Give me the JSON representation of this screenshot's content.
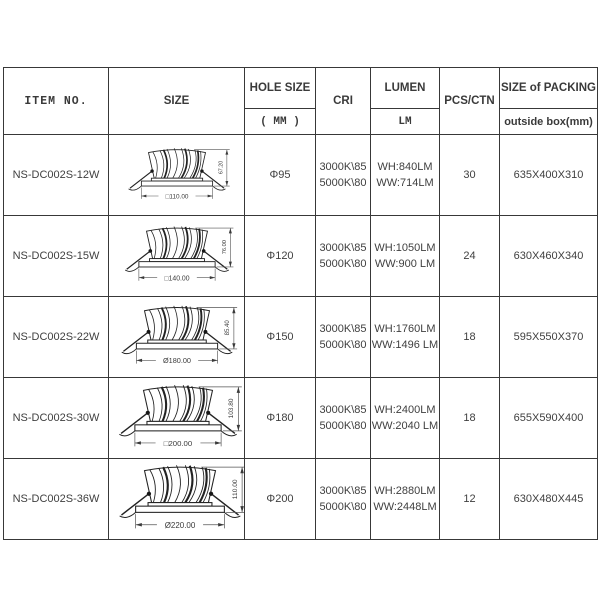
{
  "colors": {
    "background": "#ffffff",
    "border": "#383838",
    "text": "#3d3d3d",
    "drawing_line": "#222222"
  },
  "table": {
    "headers": {
      "item_no": "ITEM NO.",
      "size": "SIZE",
      "hole_size": "HOLE SIZE",
      "hole_size_sub": "( MM )",
      "cri": "CRI",
      "lumen": "LUMEN",
      "lumen_sub": "LM",
      "pcs_ctn": "PCS/CTN",
      "packing": "SIZE of PACKING",
      "packing_sub": "outside box(mm)"
    },
    "rows": [
      {
        "item_no": "NS-DC002S-12W",
        "dim_width": "□110.00",
        "dim_height": "67.20",
        "hole_size": "Φ95",
        "cri_line1": "3000K\\85",
        "cri_line2": "5000K\\80",
        "lumen_line1": "WH:840LM",
        "lumen_line2": "WW:714LM",
        "pcs_ctn": "30",
        "packing": "635X400X310"
      },
      {
        "item_no": "NS-DC002S-15W",
        "dim_width": "□140.00",
        "dim_height": "76.00",
        "hole_size": "Φ120",
        "cri_line1": "3000K\\85",
        "cri_line2": "5000K\\80",
        "lumen_line1": "WH:1050LM",
        "lumen_line2": "WW:900 LM",
        "pcs_ctn": "24",
        "packing": "630X460X340"
      },
      {
        "item_no": "NS-DC002S-22W",
        "dim_width": "Ø180.00",
        "dim_height": "85.40",
        "hole_size": "Φ150",
        "cri_line1": "3000K\\85",
        "cri_line2": "5000K\\80",
        "lumen_line1": "WH:1760LM",
        "lumen_line2": "WW:1496 LM",
        "pcs_ctn": "18",
        "packing": "595X550X370"
      },
      {
        "item_no": "NS-DC002S-30W",
        "dim_width": "□200.00",
        "dim_height": "103.80",
        "hole_size": "Φ180",
        "cri_line1": "3000K\\85",
        "cri_line2": "5000K\\80",
        "lumen_line1": "WH:2400LM",
        "lumen_line2": "WW:2040 LM",
        "pcs_ctn": "18",
        "packing": "655X590X400"
      },
      {
        "item_no": "NS-DC002S-36W",
        "dim_width": "Ø220.00",
        "dim_height": "110.00",
        "hole_size": "Φ200",
        "cri_line1": "3000K\\85",
        "cri_line2": "5000K\\80",
        "lumen_line1": "WH:2880LM",
        "lumen_line2": "WW:2448LM",
        "pcs_ctn": "12",
        "packing": "630X480X445"
      }
    ]
  }
}
